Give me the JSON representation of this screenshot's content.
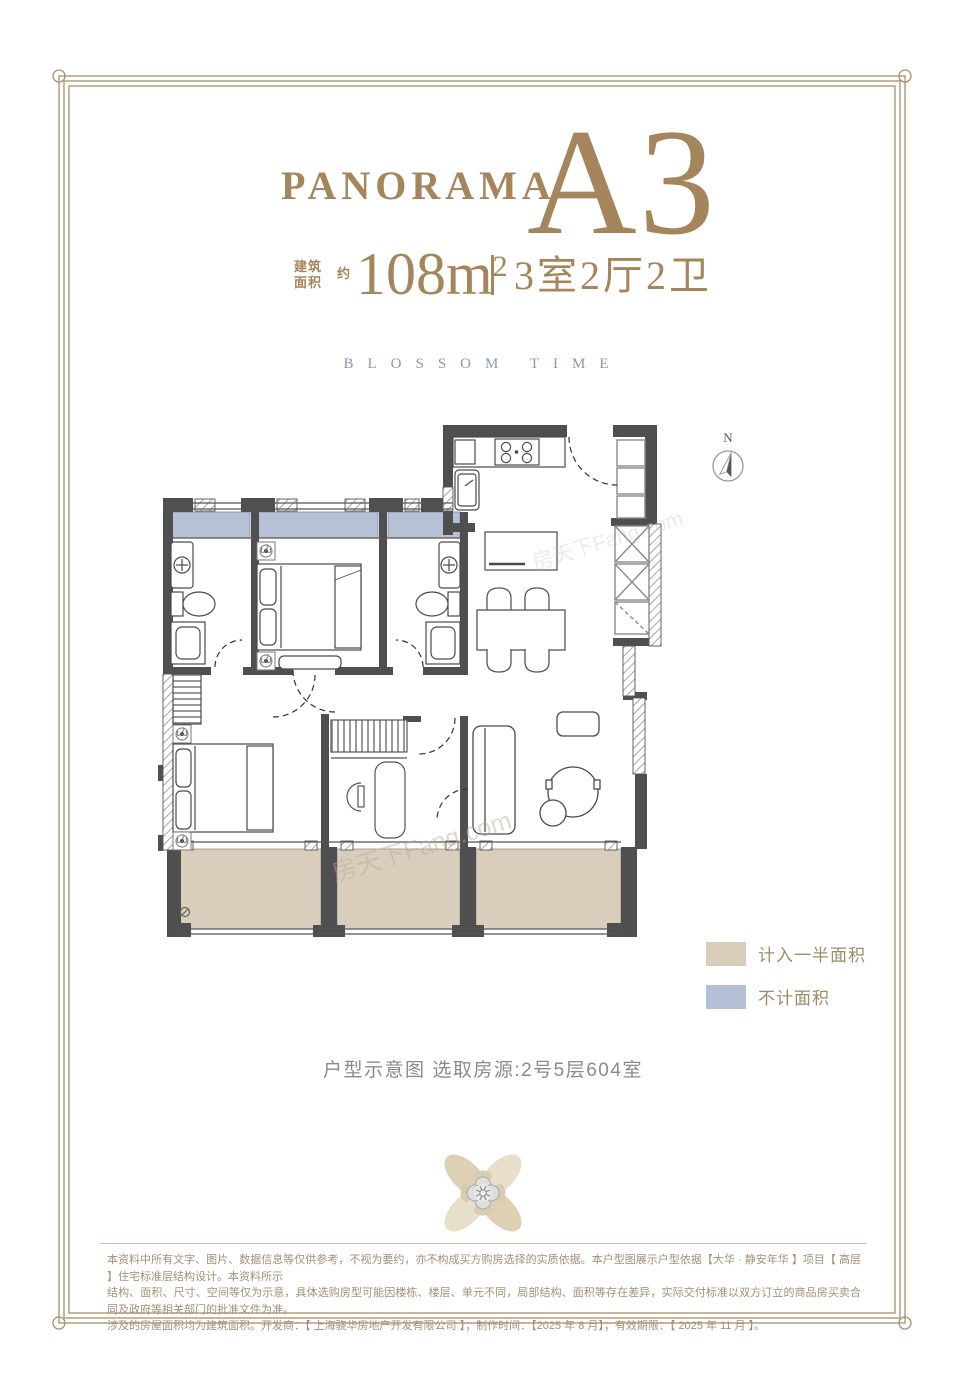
{
  "title": {
    "brand": "PANORAMA",
    "unit": "A3",
    "color": "#a5855c"
  },
  "area": {
    "prefix_top": "建筑",
    "prefix_bottom": "面积",
    "approx": "约",
    "value": "108m",
    "sup": "2",
    "rooms": "3室2厅2卫"
  },
  "subtitle": "BLOSSOM TIME",
  "compass": {
    "label": "N"
  },
  "floor_plan": {
    "watermark": "房天下Fang.com",
    "zones": {
      "half_area_color": "#d9cdbc",
      "excluded_color": "#b7c1d5"
    }
  },
  "legend": {
    "items": [
      {
        "label": "计入一半面积",
        "color": "#d9cdbc"
      },
      {
        "label": "不计面积",
        "color": "#b4c0d6"
      }
    ]
  },
  "caption": "户型示意图 选取房源:2号5层604室",
  "frame": {
    "color": "#a9906e"
  },
  "disclaimer": {
    "lines": [
      "本资料中所有文字、图片、数据信息等仅供参考，不视为要约，亦不构成买方购房选择的实质依据。本户型图展示户型依据【大华 · 静安年华 】项目【 高层 】住宅标准层结构设计。本资料所示",
      "结构、面积、尺寸、空间等仅为示意，具体选购房型可能因楼栋、楼层、单元不同，局部结构、面积等存在差异，实际交付标准以双方订立的商品房买卖合同及政府等相关部门的批准文件为准。",
      "涉及的房屋面积均为建筑面积。开发商：【 上海骁华房地产开发有限公司  】；制作时间：【2025 年 8 月】；有效期限：【 2025 年 11 月 】。"
    ]
  }
}
